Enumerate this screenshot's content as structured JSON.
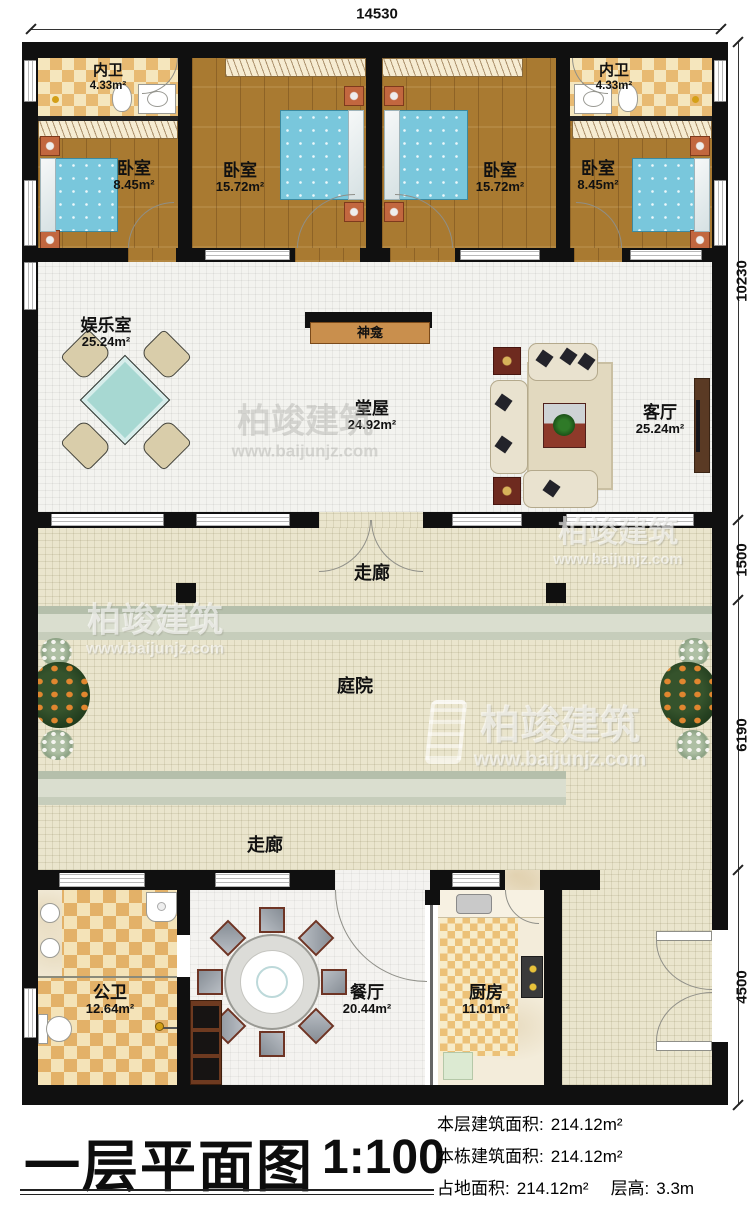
{
  "title_block": {
    "title": "一层平面图",
    "scale": "1:100",
    "stats": [
      {
        "label": "本层建筑面积:",
        "value": "214.12m²"
      },
      {
        "label": "本栋建筑面积:",
        "value": "214.12m²"
      },
      {
        "label": "占地面积:",
        "value": "214.12m²"
      },
      {
        "label": "层高:",
        "value": "3.3m"
      }
    ]
  },
  "dimensions": {
    "top": "14530",
    "right_upper": "10230",
    "right_corridor": "1500",
    "right_courtyard": "6190",
    "right_entry": "4500"
  },
  "rooms": {
    "bath_left": {
      "name": "内卫",
      "area": "4.33m²"
    },
    "bedroom_small_left": {
      "name": "卧室",
      "area": "8.45m²"
    },
    "bedroom_large_left": {
      "name": "卧室",
      "area": "15.72m²"
    },
    "bedroom_large_right": {
      "name": "卧室",
      "area": "15.72m²"
    },
    "bath_right": {
      "name": "内卫",
      "area": "4.33m²"
    },
    "bedroom_small_right": {
      "name": "卧室",
      "area": "8.45m²"
    },
    "recreation": {
      "name": "娱乐室",
      "area": "25.24m²"
    },
    "shrine": {
      "name": "神龛"
    },
    "hall": {
      "name": "堂屋",
      "area": "24.92m²"
    },
    "living": {
      "name": "客厅",
      "area": "25.24m²"
    },
    "corridor_upper": {
      "name": "走廊"
    },
    "courtyard": {
      "name": "庭院"
    },
    "corridor_lower": {
      "name": "走廊"
    },
    "public_bath": {
      "name": "公卫",
      "area": "12.64m²"
    },
    "dining": {
      "name": "餐厅",
      "area": "20.44m²"
    },
    "kitchen": {
      "name": "厨房",
      "area": "11.01m²"
    }
  },
  "watermark": {
    "brand": "柏竣建筑",
    "site": "www.baijunjz.com"
  },
  "colors": {
    "wall": "#101010",
    "wood_floor": "#a97a31",
    "bath_checker": "#e8ba72",
    "bed": "#79c7dc",
    "courtyard_tile": "#eae5cd",
    "path_strip": "#c6cdbb"
  }
}
